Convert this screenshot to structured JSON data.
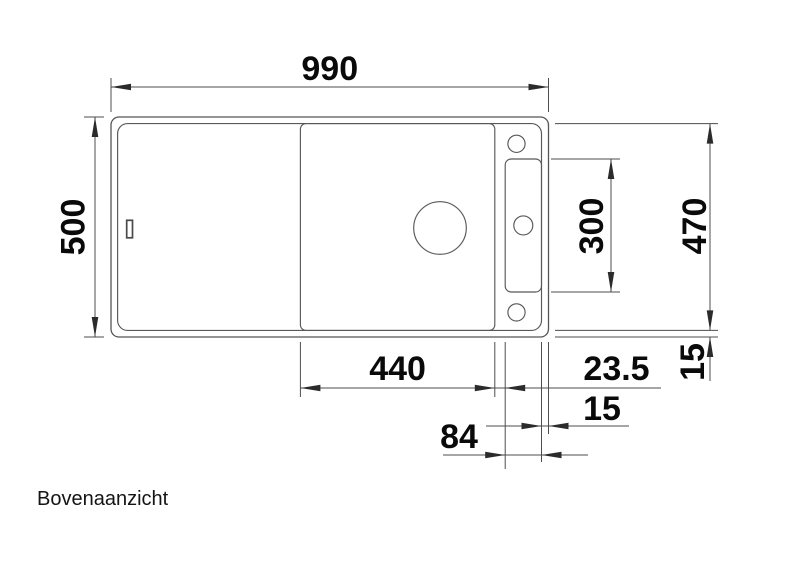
{
  "meta": {
    "caption": "Bovenaanzicht",
    "drawing_type": "sink-top-view-technical-drawing",
    "line_color": "#555555",
    "text_color": "#0a0a0a",
    "background_color": "#ffffff"
  },
  "dims": {
    "overall_width": "990",
    "overall_depth": "500",
    "inner_rim_depth": "470",
    "tap_panel_length": "300",
    "bowl_width": "440",
    "bowl_to_panel_gap": "23.5",
    "rim_offset_right": "15",
    "rim_offset_bottom": "15",
    "tap_panel_width": "84"
  }
}
